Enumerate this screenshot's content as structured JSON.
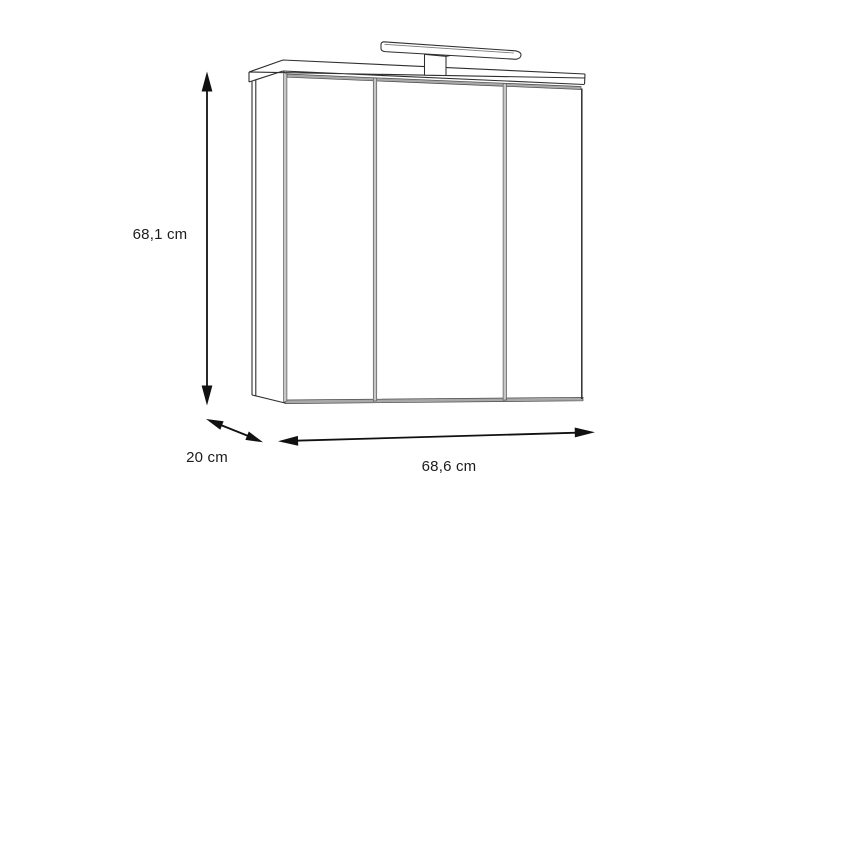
{
  "diagram": {
    "labels": {
      "height": "68,1 cm",
      "depth": "20 cm",
      "width": "68,6 cm"
    },
    "colors": {
      "line": "#2e2e2e",
      "arrow": "#111111",
      "face_white": "#ffffff",
      "gap_gray": "#c6c6c6",
      "strip_gray": "#a8a8a8"
    }
  }
}
